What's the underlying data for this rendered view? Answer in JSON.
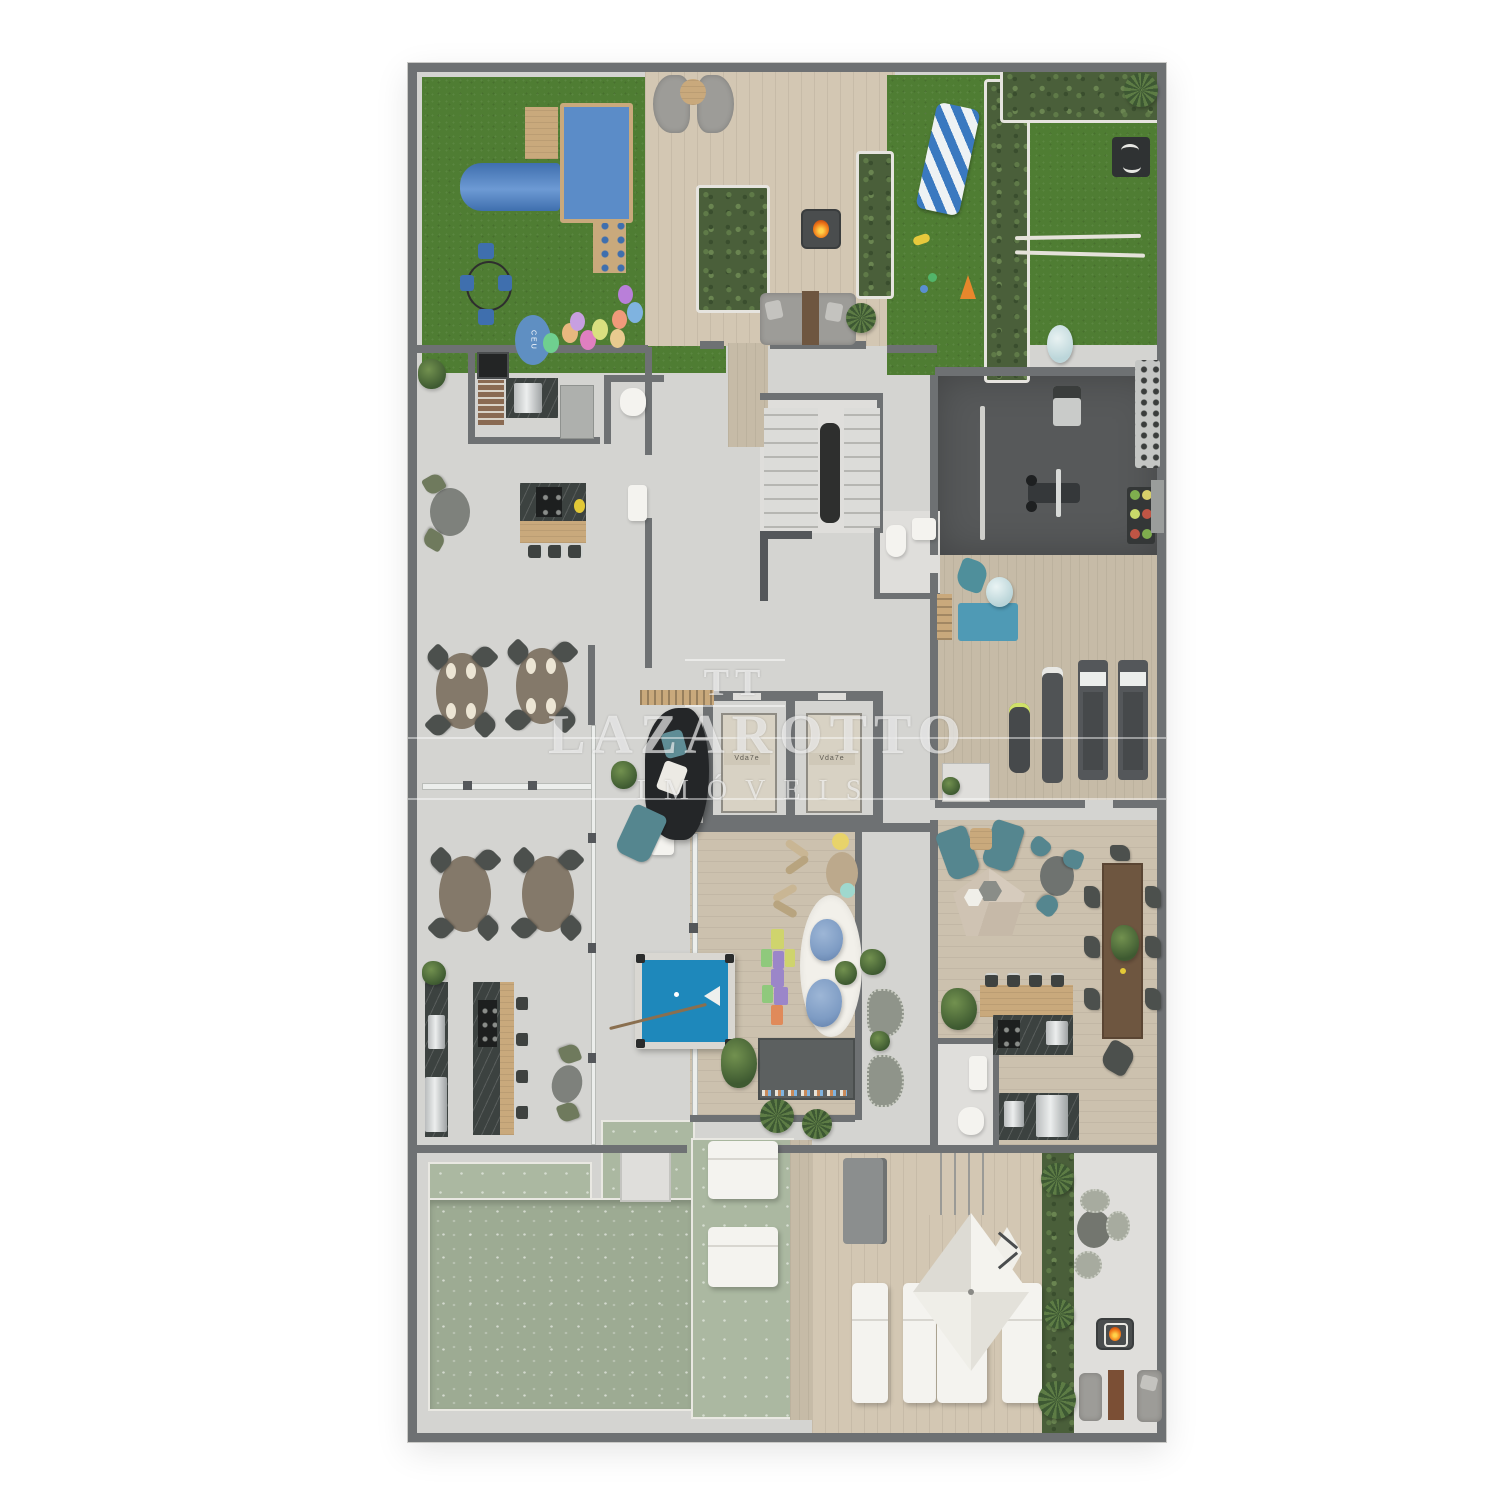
{
  "watermark": {
    "monogram": "TT",
    "title": "LAZAROTTO",
    "subtitle": "IMÓVEIS"
  },
  "labels": {
    "elevator_cab": "Vda7e",
    "hopscotch_sky": "CEU"
  },
  "palette": {
    "wall": "#6e7173",
    "wall_dark": "#54575a",
    "floor": "#d4d4d1",
    "floor_light": "#dfdedb",
    "grass": "#4f7d33",
    "deck": "#d3c7b3",
    "wood_room": "#ccc1ae",
    "gym_floor": "#57595a",
    "pool": "#9dab93",
    "pool_light": "#abb8a1",
    "pool_table": "#1e88bb",
    "marble": "#3c4240",
    "hedge": "#4a5f3a",
    "flame": "#f07818",
    "bean_bag": "#7e9cc4",
    "teal": "#55868f",
    "white_item": "#f4f3ef",
    "wood_dark": "#6e5640",
    "tan": "#c9a97c"
  }
}
